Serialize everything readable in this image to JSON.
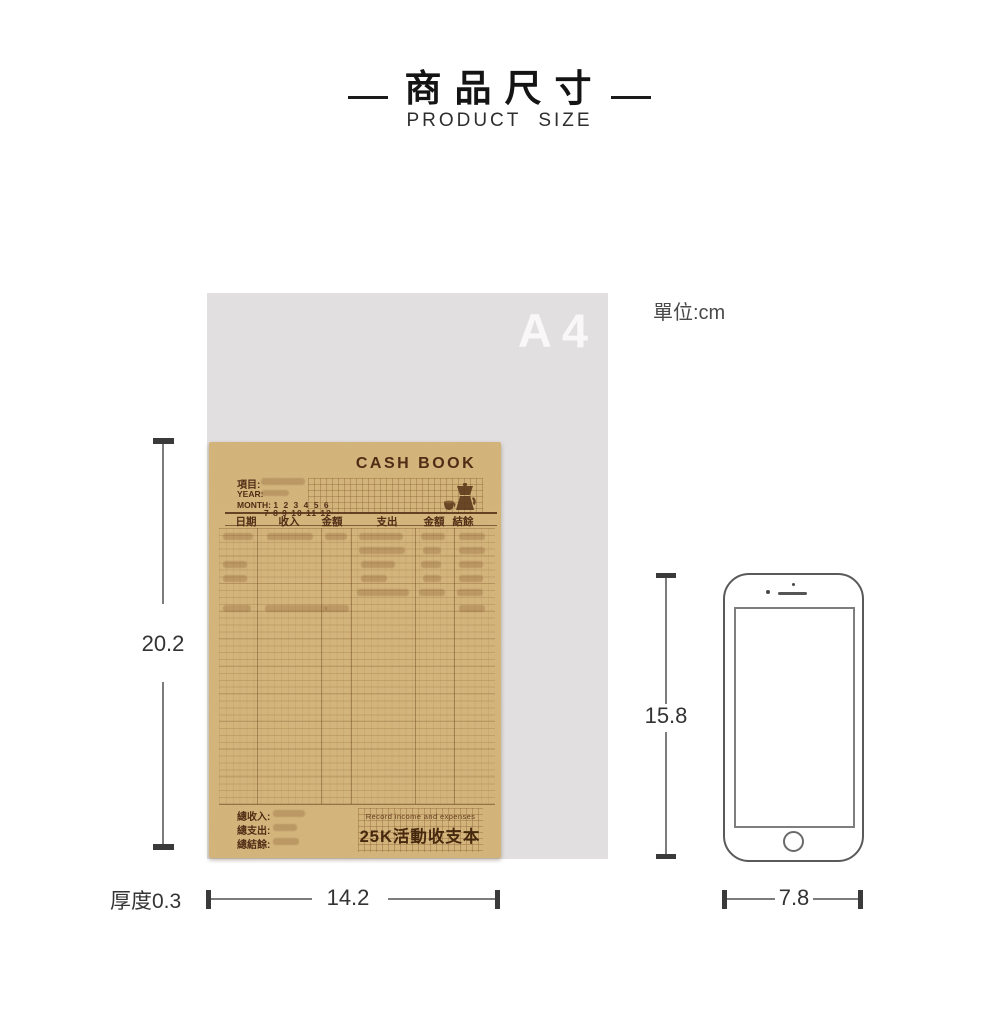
{
  "page": {
    "title": "商品尺寸",
    "subtitle": "PRODUCT SIZE",
    "unit_label": "單位:cm"
  },
  "a4": {
    "label": "A4"
  },
  "notebook": {
    "cover_title": "CASH BOOK",
    "meta": {
      "item": "項目:",
      "year": "YEAR:",
      "month": "MONTH:",
      "months_line1": "1 2 3 4 5 6",
      "months_line2": "7 8 9 10 11 12"
    },
    "headers": [
      "日期",
      "收入",
      "金額",
      "支出",
      "金額",
      "結餘"
    ],
    "totals": [
      "總收入:",
      "總支出:",
      "總結餘:"
    ],
    "caption_en": "Record income and expenses",
    "product_name": "25K活動收支本"
  },
  "dimensions": {
    "book_height": "20.2",
    "book_width": "14.2",
    "thickness": "厚度0.3",
    "phone_height": "15.8",
    "phone_width": "7.8"
  },
  "colors": {
    "a4_gray": "#e2dfe0",
    "kraft_paper": "#d6b77d",
    "cover_ink": "#4f2c15",
    "dimension_line": "#7c7c7c",
    "dimension_cap": "#3a3a3a"
  }
}
